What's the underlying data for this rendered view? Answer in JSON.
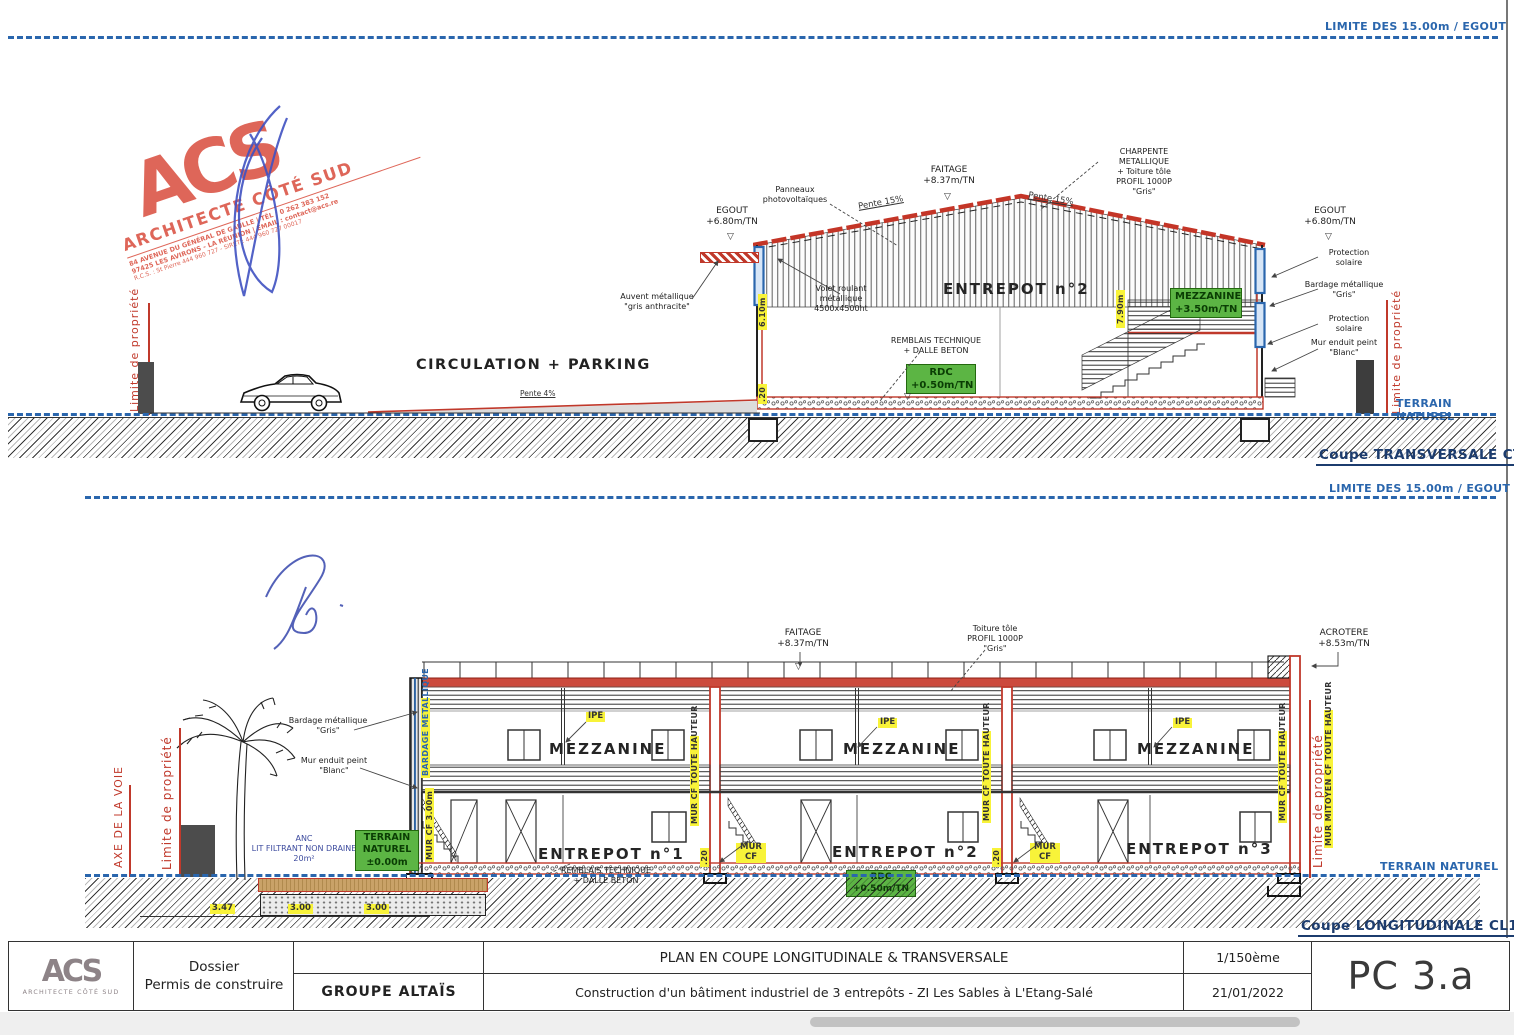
{
  "limits": {
    "top": "LIMITE DES 15.00m / EGOUT",
    "mid": "LIMITE DES 15.00m / EGOUT"
  },
  "stamp": {
    "logo": "ACS",
    "name": "ARCHITECTE CÔTÉ SUD",
    "line1": "84 AVENUE DU GÉNÉRAL DE GAULLE  |  TÉL : 0 262 383 152",
    "line2": "97425 LES AVIRONS - LA RÉUNION  |  EMAIL : contact@acs.re",
    "line3": "R.C.S. : St Pierre 444 960 727 - SIRET : 444 960 727 00017"
  },
  "ct": {
    "title": "Coupe TRANSVERSALE CT1",
    "circulation": "CIRCULATION + PARKING",
    "pente4": "Pente 4%",
    "egout_left": "EGOUT\n+6.80m/TN",
    "panneaux": "Panneaux\nphotovoltaïques",
    "pente15_left": "Pente 15%",
    "faitage": "FAITAGE\n+8.37m/TN",
    "pente15_right": "Pente 15%",
    "charpente": "CHARPENTE METALLIQUE\n+ Toiture tôle\nPROFIL 1000P\n\"Gris\"",
    "egout_right": "EGOUT\n+6.80m/TN",
    "protection_solaire": "Protection\nsolaire",
    "bardage": "Bardage métallique\n\"Gris\"",
    "mur_enduit": "Mur enduit peint\n\"Blanc\"",
    "auvent": "Auvent métallique\n\"gris anthracite\"",
    "volet": "Volet roulant\nmétallique\n4500x4500ht",
    "entrepot2": "ENTREPOT n°2",
    "mezzanine_box": "MEZZANINE\n+3.50m/TN",
    "remblais": "REMBLAIS TECHNIQUE\n+ DALLE BETON",
    "rdc_box": "RDC\n+0.50m/TN",
    "terrain": "TERRAIN NATUREL",
    "limite": "Limite de propriété",
    "dim_wall": "6.10m",
    "dim_slab": ".20",
    "dim_mid": "7.90m"
  },
  "cl": {
    "title": "Coupe LONGITUDINALE CL1",
    "faitage": "FAITAGE\n+8.37m/TN",
    "toiture": "Toiture tôle\nPROFIL 1000P\n\"Gris\"",
    "acrotere": "ACROTERE\n+8.53m/TN",
    "mezzanine": "MEZZANINE",
    "entrepots": [
      "ENTREPOT n°1",
      "ENTREPOT n°2",
      "ENTREPOT n°3"
    ],
    "ipe": "IPE",
    "remblais": "REMBLAIS TECHNIQUE\n+ DALLE BETON",
    "rdc_box": "RDC\n+0.50m/TN",
    "mur_cf": "MUR\nCF",
    "mur_cf_th": "MUR CF TOUTE HAUTEUR",
    "mur_mitoyen": "MUR MITOYEN CF TOUTE HAUTEUR",
    "mur_cf3": "MUR CF 3.00m",
    "bardage_v": "BARDAGE METALLIQUE",
    "bardage": "Bardage métallique\n\"Gris\"",
    "mur_enduit": "Mur enduit peint\n\"Blanc\"",
    "axe": "AXE DE LA VOIE",
    "limite": "Limite de propriété",
    "anc": "ANC\nLIT FILTRANT NON DRAINE\n20m²",
    "tn_box": "TERRAIN\nNATUREL\n±0.00m",
    "terrain": "TERRAIN NATUREL",
    "dims": [
      "3.47",
      "3.00",
      "3.00"
    ],
    "dim_slab": ".20"
  },
  "titleblock": {
    "logo": "ACS",
    "logo_name": "ARCHITECTE CÔTÉ SUD",
    "dossier": "Dossier\nPermis de construire",
    "client": "GROUPE ALTAÏS",
    "plan_title": "PLAN EN COUPE LONGITUDINALE & TRANSVERSALE",
    "project": "Construction d'un bâtiment industriel de 3 entrepôts - ZI Les Sables à L'Etang-Salé",
    "scale": "1/150ème",
    "date": "21/01/2022",
    "ref": "PC 3.a"
  }
}
